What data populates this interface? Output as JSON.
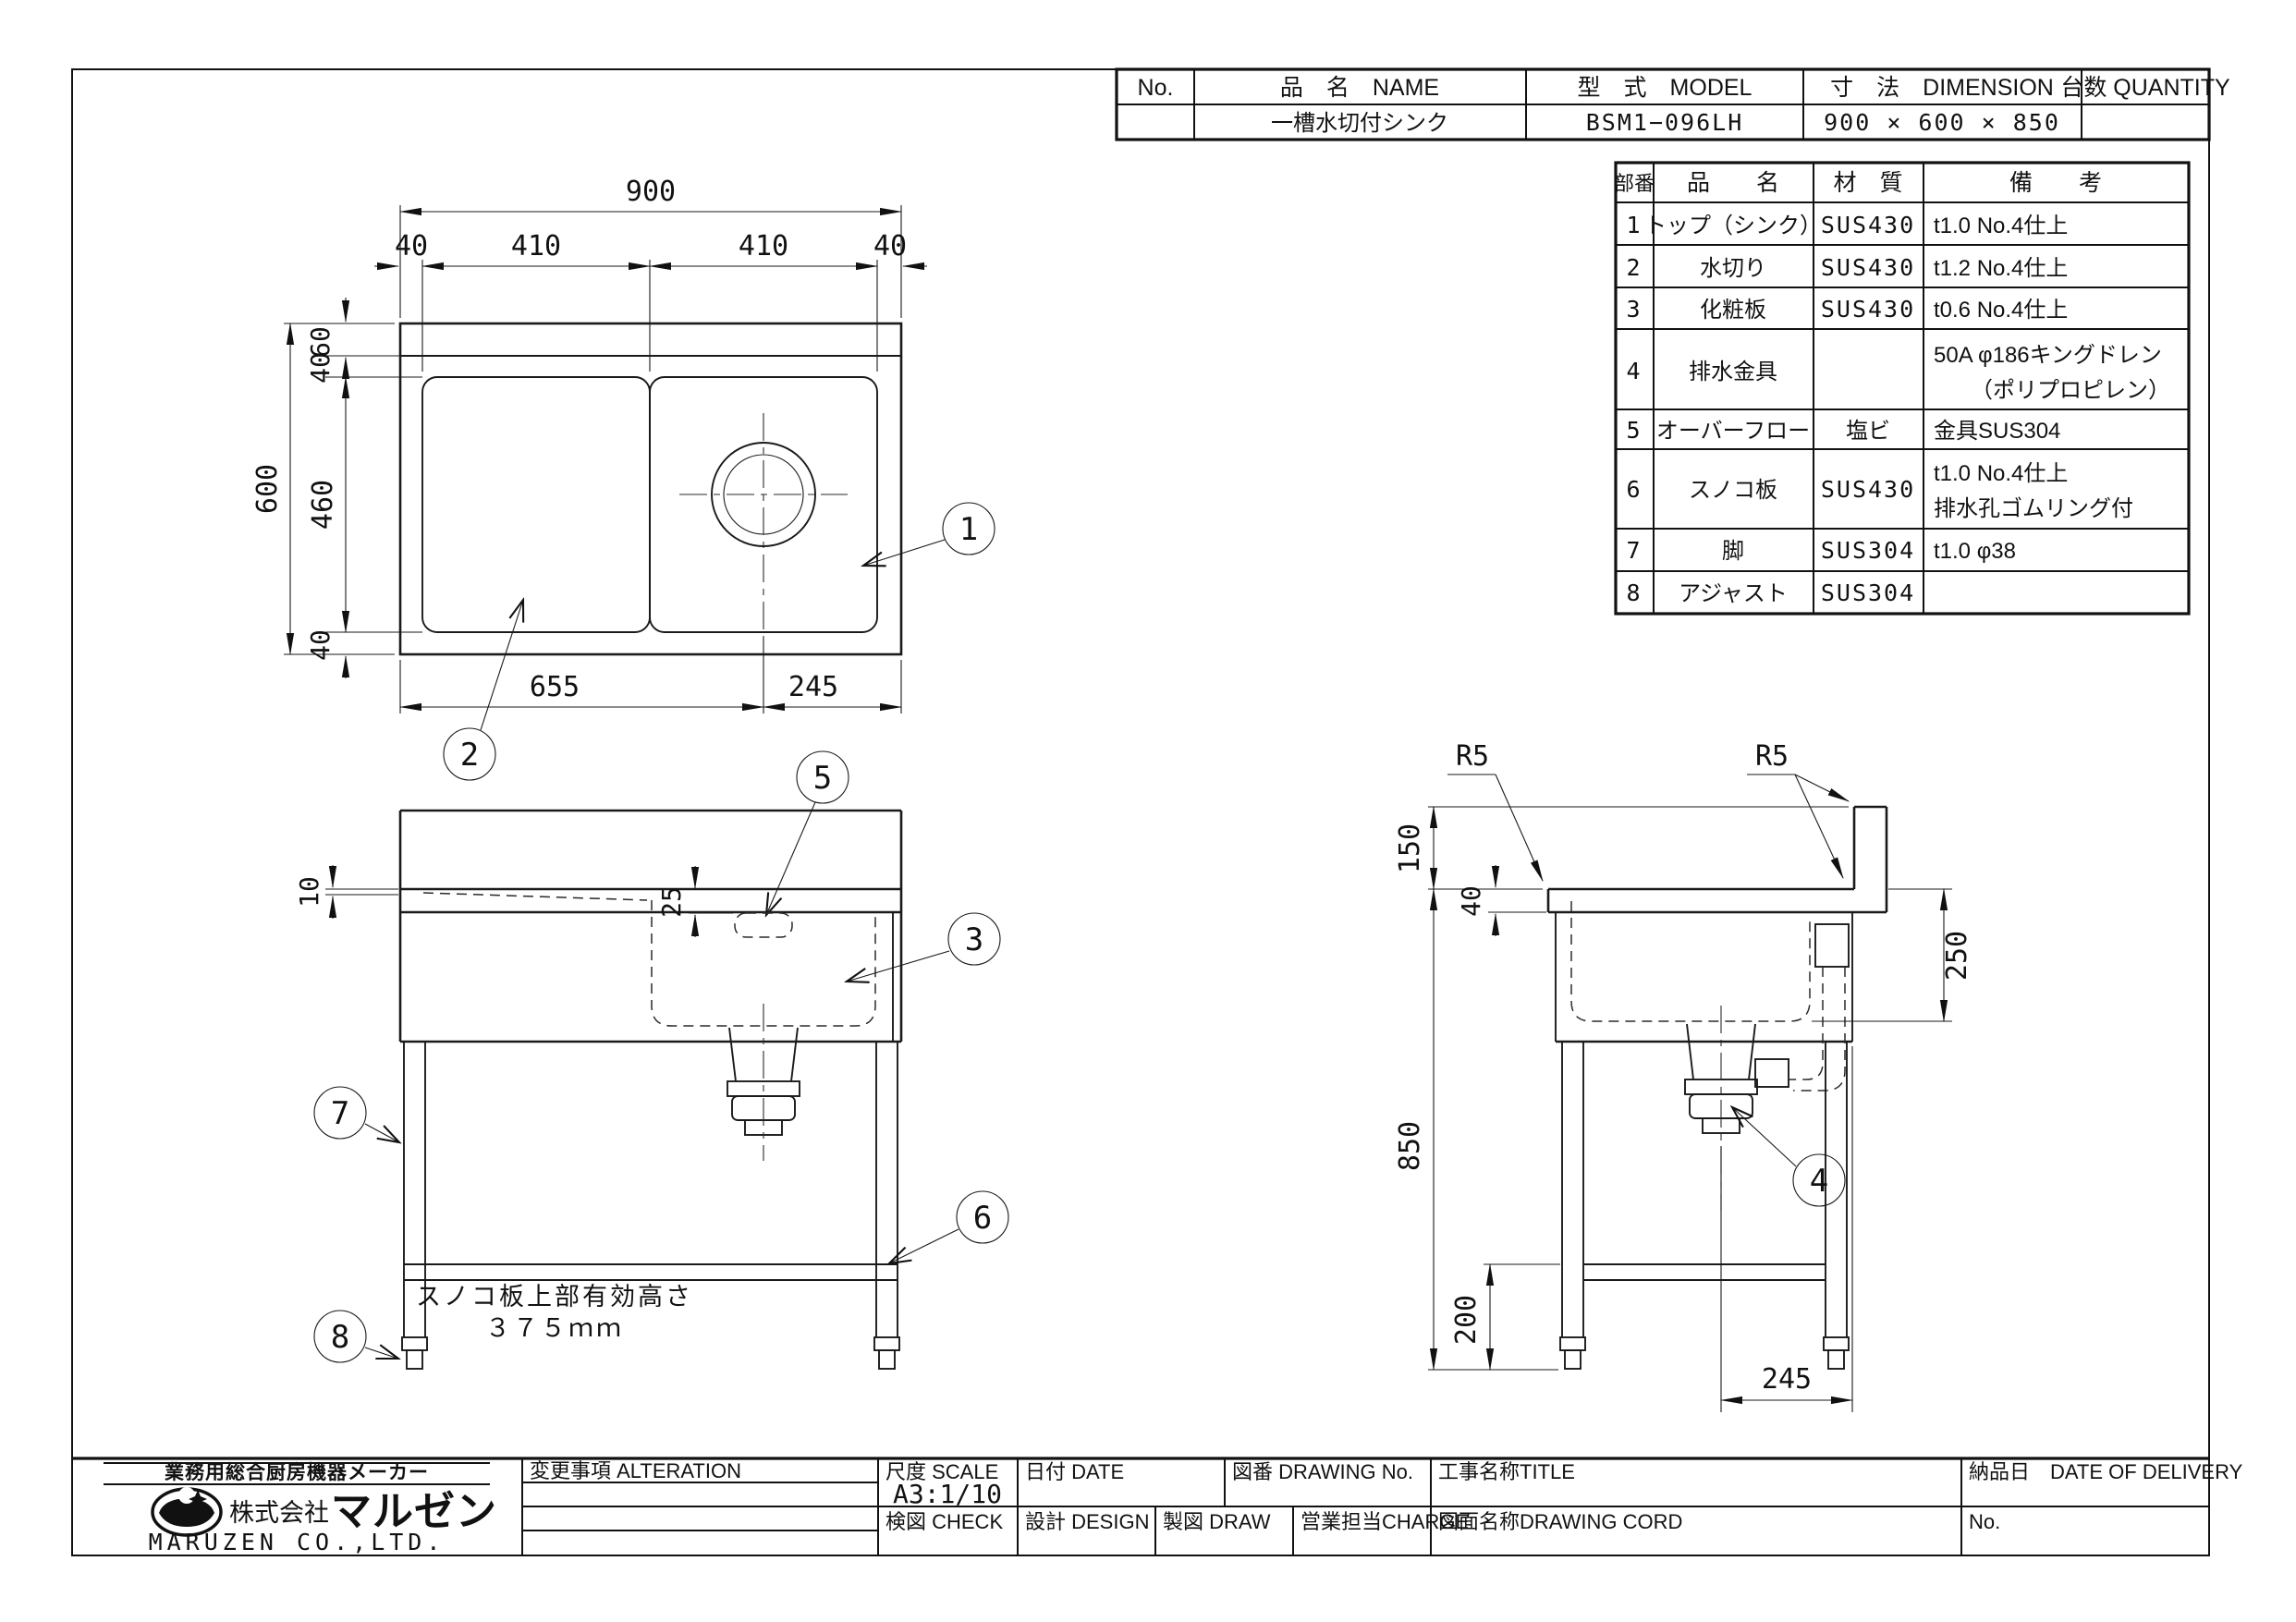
{
  "header_table": {
    "col_no": "No.",
    "col_name": "品　名　NAME",
    "col_model": "型　式　MODEL",
    "col_dimension": "寸　法　DIMENSION",
    "col_quantity": "台数 QUANTITY",
    "row": {
      "no": "",
      "name": "一槽水切付シンク",
      "model": "BSM1−096LH",
      "dimension": "900 × 600 × 850",
      "quantity": ""
    }
  },
  "parts_table": {
    "col_ref": "部番",
    "col_name": "品　　名",
    "col_material": "材　質",
    "col_remarks": "備　　考",
    "rows": [
      {
        "ref": "1",
        "name": "トップ（シンク）",
        "material": "SUS430",
        "remarks": "t1.0 No.4仕上",
        "remarks2": ""
      },
      {
        "ref": "2",
        "name": "水切り",
        "material": "SUS430",
        "remarks": "t1.2 No.4仕上",
        "remarks2": ""
      },
      {
        "ref": "3",
        "name": "化粧板",
        "material": "SUS430",
        "remarks": "t0.6 No.4仕上",
        "remarks2": ""
      },
      {
        "ref": "4",
        "name": "排水金具",
        "material": "",
        "remarks": "50A φ186キングドレン",
        "remarks2": "（ポリプロピレン）"
      },
      {
        "ref": "5",
        "name": "オーバーフロー",
        "material": "塩ビ",
        "remarks": "金具SUS304",
        "remarks2": ""
      },
      {
        "ref": "6",
        "name": "スノコ板",
        "material": "SUS430",
        "remarks": "t1.0 No.4仕上",
        "remarks2": "排水孔ゴムリング付"
      },
      {
        "ref": "7",
        "name": "脚",
        "material": "SUS304",
        "remarks": "t1.0 φ38",
        "remarks2": ""
      },
      {
        "ref": "8",
        "name": "アジャスト",
        "material": "SUS304",
        "remarks": "",
        "remarks2": ""
      }
    ]
  },
  "title_block": {
    "maker_tagline": "業務用総合厨房機器メーカー",
    "company_prefix": "株式会社",
    "company_brand": "マルゼン",
    "company_en": "MARUZEN CO.,LTD.",
    "alteration_label": "変更事項  ALTERATION",
    "scale_label": "尺度 SCALE",
    "scale_value": "A3:1/10",
    "date_label": "日付 DATE",
    "drawing_no_label": "図番 DRAWING  No.",
    "title_label": "工事名称TITLE",
    "delivery_label": "納品日　DATE OF DELIVERY",
    "check_label": "検図 CHECK",
    "design_label": "設計 DESIGN",
    "draw_label": "製図 DRAW",
    "charge_label": "営業担当CHARGE",
    "drawing_cord_label": "図面名称DRAWING  CORD",
    "no_label": "No."
  },
  "plan_view": {
    "dim_overall_width": "900",
    "dim_margin_left": "40",
    "dim_span_left": "410",
    "dim_span_right": "410",
    "dim_margin_right": "40",
    "dim_overall_depth": "600",
    "dim_bowl_depth": "460",
    "dim_backsplash_depth": "60",
    "dim_rim_top": "40",
    "dim_rim_bottom": "40",
    "dim_to_drain": "655",
    "dim_drain_to_edge": "245"
  },
  "front_view": {
    "dim_drainboard_recess": "10",
    "dim_overflow_offset": "25",
    "note_line1": "スノコ板上部有効高さ",
    "note_line2": "３７５ｍｍ"
  },
  "side_view": {
    "radius_front": "R5",
    "radius_rear": "R5",
    "dim_backsplash_height": "150",
    "dim_edge_height": "40",
    "dim_overall_height": "850",
    "dim_bowl_depth": "250",
    "dim_shelf_height": "200",
    "dim_drain_offset": "245"
  },
  "balloons": {
    "b1": "1",
    "b2": "2",
    "b3": "3",
    "b4": "4",
    "b5": "5",
    "b6": "6",
    "b7": "7",
    "b8": "8"
  }
}
